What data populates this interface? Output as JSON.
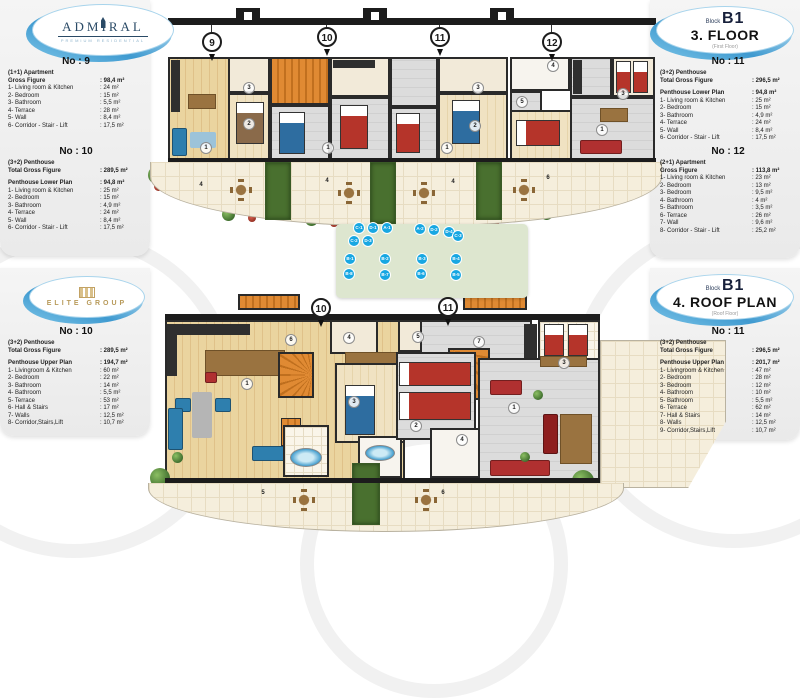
{
  "logos": {
    "admiral": {
      "name": "ADMIRAL",
      "tagline": "PREMIUM RESIDENTIAL"
    },
    "elite": {
      "name": "ELITE GROUP"
    }
  },
  "badges": {
    "top": {
      "block_label": "Block",
      "block": "B1",
      "title": "3. FLOOR",
      "subtitle": "(First Floor)"
    },
    "bottom": {
      "block_label": "Block",
      "block": "B1",
      "title": "4. ROOF PLAN",
      "subtitle": "(Roof Floor)"
    }
  },
  "specs": {
    "p9": {
      "title": "No : 9",
      "type": "(1+1) Apartment",
      "gross_label": "Gross Figure",
      "gross_value": ": 98,4 m²",
      "rooms": [
        {
          "l": "1- Living room & Kitchen",
          "v": ": 24 m²"
        },
        {
          "l": "2- Bedroom",
          "v": ": 15 m²"
        },
        {
          "l": "3- Bathroom",
          "v": ": 5,5 m²"
        },
        {
          "l": "4- Terrace",
          "v": ": 28 m²"
        },
        {
          "l": "5- Wall",
          "v": ": 8,4 m²"
        },
        {
          "l": "6- Corridor - Stair - Lift",
          "v": ": 17,5 m²"
        }
      ]
    },
    "p10L": {
      "title": "No : 10",
      "type": "(3+2) Penthouse",
      "gross_label": "Total Gross Figure",
      "gross_value": ": 289,5 m²",
      "plan_label": "Penthouse Lower Plan",
      "plan_value": ": 94,8 m²",
      "rooms": [
        {
          "l": "1- Living room & Kitchen",
          "v": ": 25 m²"
        },
        {
          "l": "2- Bedroom",
          "v": ": 15 m²"
        },
        {
          "l": "3- Bathroom",
          "v": ": 4,9 m²"
        },
        {
          "l": "4- Terrace",
          "v": ": 24 m²"
        },
        {
          "l": "5- Wall",
          "v": ": 8,4 m²"
        },
        {
          "l": "6- Corridor - Stair - Lift",
          "v": ": 17,5 m²"
        }
      ]
    },
    "p11L": {
      "title": "No : 11",
      "type": "(3+2) Penthouse",
      "gross_label": "Total Gross Figure",
      "gross_value": ": 296,5 m²",
      "plan_label": "Penthouse Lower Plan",
      "plan_value": ": 94,8 m²",
      "rooms": [
        {
          "l": "1- Living room & Kitchen",
          "v": ": 25 m²"
        },
        {
          "l": "2- Bedroom",
          "v": ": 15 m²"
        },
        {
          "l": "3- Bathroom",
          "v": ": 4,9 m²"
        },
        {
          "l": "4- Terrace",
          "v": ": 24 m²"
        },
        {
          "l": "5- Wall",
          "v": ": 8,4 m²"
        },
        {
          "l": "6- Corridor - Stair - Lift",
          "v": ": 17,5 m²"
        }
      ]
    },
    "p12": {
      "title": "No : 12",
      "type": "(2+1) Apartment",
      "gross_label": "Gross Figure",
      "gross_value": ": 113,8 m²",
      "rooms": [
        {
          "l": "1- Living room & Kitchen",
          "v": ": 23 m²"
        },
        {
          "l": "2- Bedroom",
          "v": ": 13 m²"
        },
        {
          "l": "3- Bedroom",
          "v": ": 9,5 m²"
        },
        {
          "l": "4- Bathroom",
          "v": ": 4 m²"
        },
        {
          "l": "5- Bathroom",
          "v": ": 3,5 m²"
        },
        {
          "l": "6- Terrace",
          "v": ": 26 m²"
        },
        {
          "l": "7- Wall",
          "v": ": 9,6 m²"
        },
        {
          "l": "8- Corridor - Stair - Lift",
          "v": ": 25,2 m²"
        }
      ]
    },
    "p10U": {
      "title": "No : 10",
      "type": "(3+2) Penthouse",
      "gross_label": "Total Gross Figure",
      "gross_value": ": 289,5 m²",
      "plan_label": "Penthouse Upper Plan",
      "plan_value": ": 194,7 m²",
      "rooms": [
        {
          "l": "1- Livingroom & Kitchen",
          "v": ": 60 m²"
        },
        {
          "l": "2- Bedroom",
          "v": ": 22 m²"
        },
        {
          "l": "3- Bathroom",
          "v": ": 14 m²"
        },
        {
          "l": "4- Bathroom",
          "v": ": 5,5 m²"
        },
        {
          "l": "5- Terrace",
          "v": ": 53 m²"
        },
        {
          "l": "6- Hall & Stairs",
          "v": ": 17 m²"
        },
        {
          "l": "7- Walls",
          "v": ": 12,5 m²"
        },
        {
          "l": "8- Corridor,Stairs,Lift",
          "v": ": 10,7 m²"
        }
      ]
    },
    "p11U": {
      "title": "No : 11",
      "type": "(3+2) Penthouse",
      "gross_label": "Total Gross Figure",
      "gross_value": ": 296,5 m²",
      "plan_label": "Penthouse Upper Plan",
      "plan_value": ": 201,7 m²",
      "rooms": [
        {
          "l": "1- Livingroom & Kitchen",
          "v": ": 47 m²"
        },
        {
          "l": "2- Bedroom",
          "v": ": 28 m²"
        },
        {
          "l": "3- Bedroom",
          "v": ": 12 m²"
        },
        {
          "l": "4- Bathroom",
          "v": ": 10 m²"
        },
        {
          "l": "5- Bathroom",
          "v": ": 5,5 m²"
        },
        {
          "l": "6- Terrace",
          "v": ": 62 m²"
        },
        {
          "l": "7- Hall & Stairs",
          "v": ": 14 m²"
        },
        {
          "l": "8- Walls",
          "v": ": 12,5 m²"
        },
        {
          "l": "9- Corridor,Stairs,Lift",
          "v": ": 10,7 m²"
        }
      ]
    }
  },
  "plans": {
    "top": {
      "units": [
        "9",
        "10",
        "11",
        "12"
      ],
      "labels": [
        "3",
        "2",
        "1",
        "3",
        "2",
        "1",
        "1",
        "1",
        "4",
        "5",
        "3",
        "4",
        "4",
        "4",
        "6"
      ]
    },
    "bottom": {
      "units": [
        "10",
        "11"
      ],
      "labels": [
        "6",
        "1",
        "4",
        "3",
        "5",
        "7",
        "3",
        "1",
        "2",
        "4",
        "5",
        "6"
      ]
    }
  },
  "site": {
    "badges": [
      "C-1",
      "D-1",
      "A-1",
      "A-2",
      "D-2",
      "D-4",
      "C-3",
      "C-2",
      "D-3",
      "B-1",
      "B-2",
      "B-3",
      "B-4",
      "B-8",
      "B-7",
      "B-6",
      "B-5"
    ]
  },
  "colors": {
    "accent_blue": "#3f9ad0",
    "badge_blue": "#18a7e2",
    "stair_orange": "#e08a33",
    "wood": "#e6cd97",
    "bed_red": "#b5342a",
    "bed_blue": "#2e6da0"
  }
}
